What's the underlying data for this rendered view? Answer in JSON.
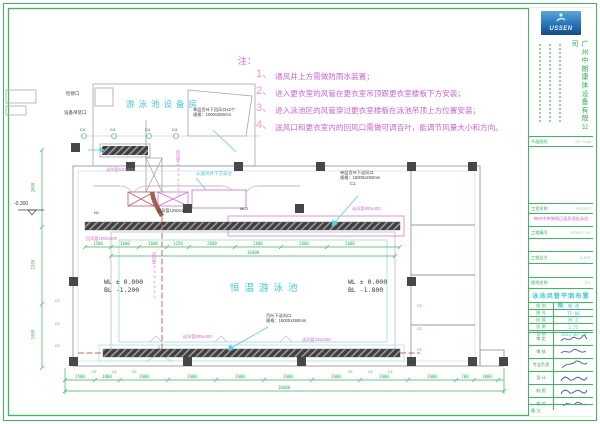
{
  "notes": {
    "heading": "注：",
    "items": [
      {
        "num": "1、",
        "text": "通风井上方需做防雨水装置；"
      },
      {
        "num": "2、",
        "text": "进入更衣室的风管在更衣室吊顶跟更衣室楼板下方安装；"
      },
      {
        "num": "3、",
        "text": "进入泳池区的风管穿过更衣室楼板在泳池吊顶上方位置安装；"
      },
      {
        "num": "4、",
        "text": "送风口和更衣室内的回风口需做可调百叶，能调节风量大小和方向。"
      }
    ]
  },
  "title_block": {
    "logo_text": "USSEN",
    "company_name": "广州中朗康体设备有限公司",
    "key_plan_label": "平面图形",
    "key_plan_label_en": "KEY PLAN",
    "project_label": "工程名称",
    "project_label_en": "PROJECT",
    "project_name": "梅州中央城假日温泉酒店泳池",
    "project_no_label": "工程编号",
    "project_no_label_en": "PROJECT NO.",
    "client_label": "工程业主",
    "client_label_en": "CLIENT",
    "drawing_title_label": "图纸名称",
    "drawing_title_label_en": "TITL",
    "drawing_title": "泳池风管平面布置图",
    "info_rows": [
      {
        "label": "图 别",
        "value": "暖 通"
      },
      {
        "label": "图 号",
        "value": "TF-08"
      },
      {
        "label": "阶 段",
        "value": "施 工"
      },
      {
        "label": "比 例",
        "value": "1:75"
      },
      {
        "label": "日 期",
        "value": "2012-03-28"
      }
    ],
    "sign_rows": [
      {
        "label": "审 定"
      },
      {
        "label": "审 核"
      },
      {
        "label": "专业负责"
      },
      {
        "label": "设 计"
      },
      {
        "label": "制 图"
      },
      {
        "label": "校 对"
      }
    ],
    "remark_label": "备 注"
  },
  "plan": {
    "inspection_port": "检修口",
    "hoist_port": "设备吊装口",
    "equipment_room": "游泳池设备房",
    "pool_name": "恒温游泳池",
    "return_grille_1": "单层百叶下回风口x2个",
    "return_grille_2": "规格：1000x250mm",
    "supply_duct_610": "送风管610x210",
    "pass_note": "从送风井下方穿过",
    "return_duct_vert": "回风管630x320",
    "tag_n1": "N1",
    "supply_duct_1250": "送风管1250x400",
    "tag_mc1": "MC1",
    "return_duct_1000": "回风管1000x400",
    "supply_outlet_top_1": "单层百叶下送风口",
    "supply_outlet_top_2": "规格：15000x260mm",
    "tag_c1": "C1",
    "supply_duct_800": "送风管800x400",
    "supply_duct_vert": "送风管630x320",
    "supply_outlet_bottom_1": "百叶下送风口",
    "supply_outlet_bottom_2": "规格：15000x260mm",
    "supply_duct_315": "送风管315x250",
    "level_wl_left": "WL ± 0.000",
    "level_bl_left": "BL -1.200",
    "level_wl_right": "WL ± 0.000",
    "level_bl_right": "BL -1.800",
    "level_entry": "-0.300",
    "tag_c4": "C4",
    "tag_c2": "C2",
    "tag_c3": "C3",
    "dims_inner": [
      "1500",
      "1600",
      "1600",
      "1250",
      "2600",
      "2600",
      "2600",
      "2600"
    ],
    "dim_pool_total": "18400",
    "dims_bottom": [
      "1500",
      "1000",
      "2600",
      "2600",
      "2600",
      "2600",
      "2600",
      "2600",
      "2600",
      "700",
      "1000"
    ],
    "dim_bottom_total": "18400",
    "dims_left": [
      "2600",
      "1500",
      "1000"
    ]
  }
}
